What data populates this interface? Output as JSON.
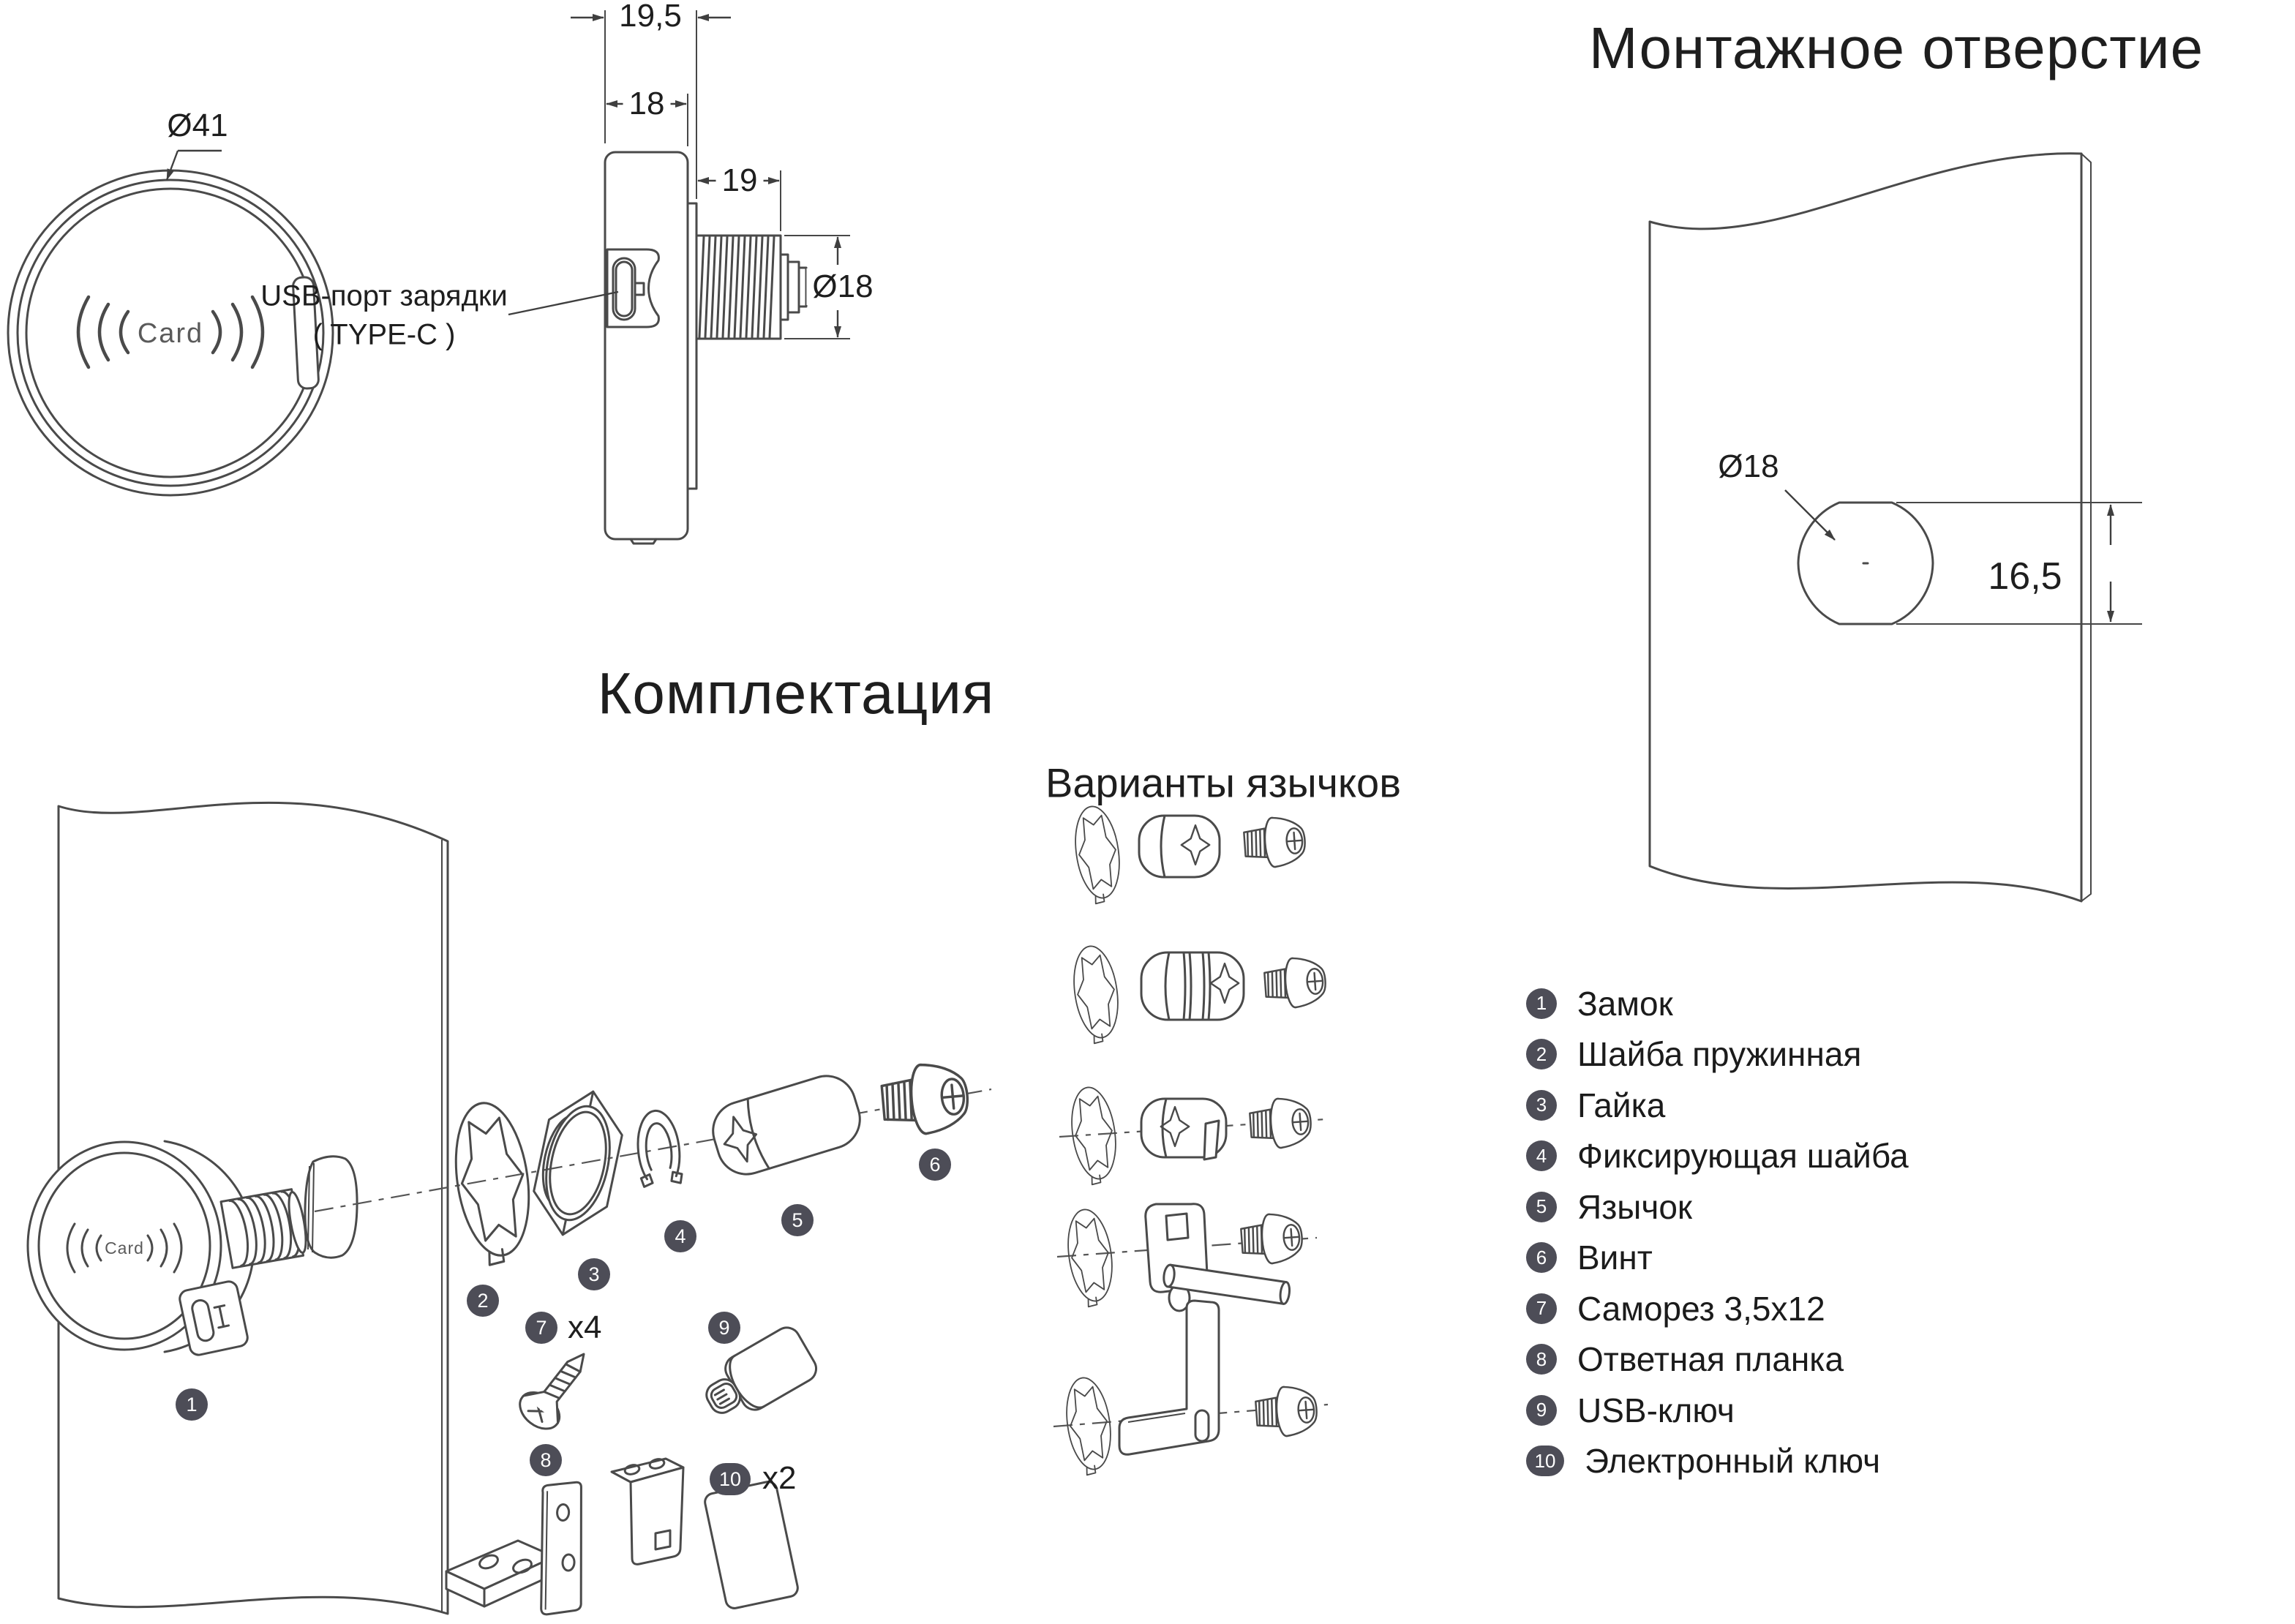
{
  "face_view": {
    "diameter_label": "Ø41",
    "card_label": "Card"
  },
  "side_view": {
    "dim_total_depth": "19,5",
    "dim_body_depth": "18",
    "dim_barrel_length": "19",
    "dim_barrel_diameter": "Ø18",
    "usb_label_line1": "USB-порт зарядки",
    "usb_label_line2": "( TYPE-C )"
  },
  "mounting_hole": {
    "title": "Монтажное отверстие",
    "dim_diameter": "Ø18",
    "dim_across_flats": "16,5"
  },
  "package": {
    "title": "Комплектация",
    "variants_title": "Варианты язычков",
    "card_label": "Card",
    "qty_screw": "x4",
    "qty_key": "x2",
    "callouts": {
      "c1": "1",
      "c2": "2",
      "c3": "3",
      "c4": "4",
      "c5": "5",
      "c6": "6",
      "c7": "7",
      "c8": "8",
      "c9": "9",
      "c10": "10"
    }
  },
  "parts_list": {
    "items": [
      {
        "num": "1",
        "label": "Замок"
      },
      {
        "num": "2",
        "label": "Шайба пружинная"
      },
      {
        "num": "3",
        "label": "Гайка"
      },
      {
        "num": "4",
        "label": "Фиксирующая шайба"
      },
      {
        "num": "5",
        "label": "Язычок"
      },
      {
        "num": "6",
        "label": "Винт"
      },
      {
        "num": "7",
        "label": "Саморез 3,5х12"
      },
      {
        "num": "8",
        "label": "Ответная планка"
      },
      {
        "num": "9",
        "label": "USB-ключ"
      },
      {
        "num": "10",
        "label": "Электронный ключ"
      }
    ]
  },
  "colors": {
    "line": "#4a4a4a",
    "badge": "#4d4d57",
    "text": "#1e1e1e",
    "background": "#ffffff"
  }
}
